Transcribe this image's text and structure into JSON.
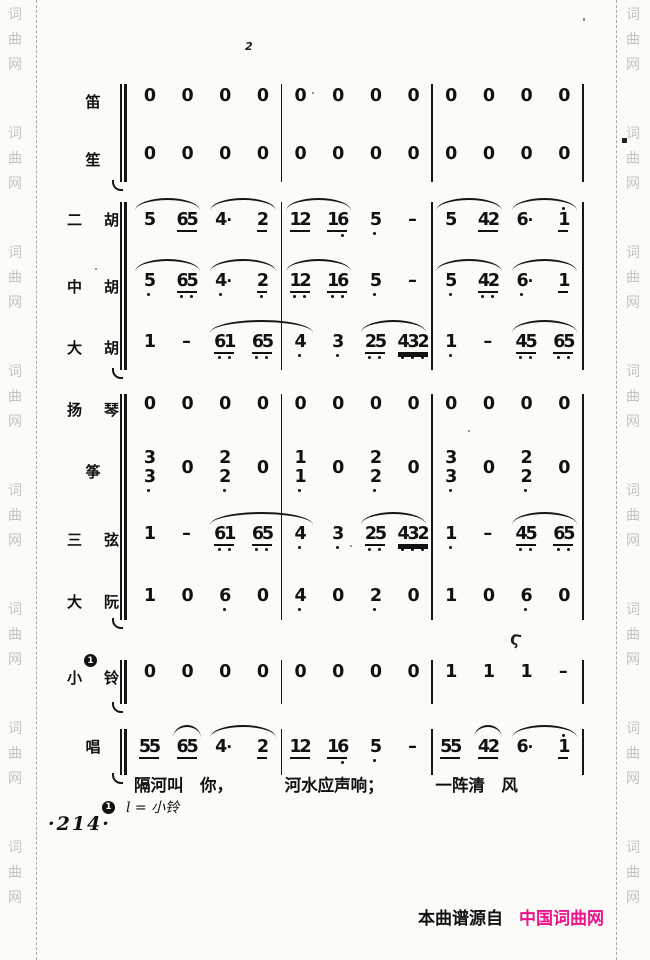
{
  "watermark": {
    "chars": [
      "词",
      "曲",
      "网"
    ],
    "repeat": 8
  },
  "footer": {
    "prefix": "本曲谱源自",
    "brand": "中国词曲网",
    "brand_color": "#ee1389"
  },
  "page_number": "·214·",
  "footnote": {
    "marker": "1",
    "text": "l = 小铃"
  },
  "lyrics": [
    "隔河叫　你，",
    "河水应声响；",
    "一阵清　风"
  ],
  "artifacts": {
    "top_mark": "2",
    "bell_mark": "Ϛ"
  },
  "score": {
    "groups": [
      {
        "rows": [
          {
            "id": "di",
            "label": "笛",
            "beats": [
              "0",
              "0",
              "0",
              "0",
              "0",
              "0",
              "0",
              "0",
              "0",
              "0",
              "0",
              "0"
            ],
            "slurs": []
          },
          {
            "id": "sheng",
            "label": "笙",
            "beats": [
              "0",
              "0",
              "0",
              "0",
              "0",
              "0",
              "0",
              "0",
              "0",
              "0",
              "0",
              "0"
            ],
            "slurs": []
          }
        ]
      },
      {
        "rows": [
          {
            "id": "erhu",
            "label": "二胡",
            "beats": [
              "5",
              "65_",
              "4*",
              "2_",
              "12_",
              "16._",
              "5.",
              "-",
              "5",
              "42_",
              "6*",
              "1'_"
            ],
            "slurs": [
              [
                0,
                1
              ],
              [
                2,
                3
              ],
              [
                4,
                5
              ],
              [
                8,
                9
              ],
              [
                10,
                11
              ]
            ]
          },
          {
            "id": "zhonghu",
            "label": "中胡",
            "beats": [
              "5.",
              "6.5._",
              "4.*",
              "2._",
              "1.2._",
              "1.6._",
              "5.",
              "-",
              "5.",
              "4.2._",
              "6.*",
              "1_"
            ],
            "slurs": [
              [
                0,
                1
              ],
              [
                2,
                3
              ],
              [
                4,
                5
              ],
              [
                8,
                9
              ],
              [
                10,
                11
              ]
            ]
          },
          {
            "id": "dahu",
            "label": "大胡",
            "beats": [
              "1",
              "-",
              "6.1._",
              "6.5._",
              "4.",
              "3.",
              "2.5._",
              "4.3.2.=",
              "1.",
              "-",
              "4.5._",
              "6.5._"
            ],
            "slurs": [
              [
                2,
                4
              ],
              [
                6,
                7
              ],
              [
                10,
                11
              ]
            ]
          }
        ]
      },
      {
        "rows": [
          {
            "id": "yangqin",
            "label": "扬琴",
            "beats": [
              "0",
              "0",
              "0",
              "0",
              "0",
              "0",
              "0",
              "0",
              "0",
              "0",
              "0",
              "0"
            ],
            "slurs": []
          },
          {
            "id": "zheng",
            "label": "筝",
            "chord": true,
            "beats": [
              "3/3.",
              "0",
              "2/2.",
              "0",
              "1/1.",
              "0",
              "2/2.",
              "0",
              "3/3.",
              "0",
              "2/2.",
              "0"
            ],
            "slurs": []
          },
          {
            "id": "sanxian",
            "label": "三弦",
            "beats": [
              "1",
              "-",
              "6.1._",
              "6.5._",
              "4.",
              "3.",
              "2.5._",
              "4.3.2.=",
              "1.",
              "-",
              "4.5._",
              "6.5._"
            ],
            "slurs": [
              [
                2,
                4
              ],
              [
                6,
                7
              ],
              [
                10,
                11
              ]
            ]
          },
          {
            "id": "daruan",
            "label": "大阮",
            "beats": [
              "1",
              "0",
              "6.",
              "0",
              "4.",
              "0",
              "2.",
              "0",
              "1",
              "0",
              "6.",
              "0"
            ],
            "slurs": []
          }
        ]
      },
      {
        "rows": [
          {
            "id": "xiaoling",
            "label": "小铃",
            "badge": "1",
            "beats": [
              "0",
              "0",
              "0",
              "0",
              "0",
              "0",
              "0",
              "0",
              "1",
              "1",
              "1",
              "-"
            ],
            "slurs": []
          }
        ]
      },
      {
        "rows": [
          {
            "id": "chang",
            "label": "唱",
            "beats": [
              "55_",
              "65_",
              "4*",
              "2_",
              "12_",
              "16._",
              "5.",
              "-",
              "55_",
              "42_",
              "6*",
              "1'_"
            ],
            "slurs": [
              [
                1,
                1
              ],
              [
                2,
                3
              ],
              [
                9,
                9
              ],
              [
                10,
                11
              ]
            ]
          }
        ]
      }
    ]
  }
}
